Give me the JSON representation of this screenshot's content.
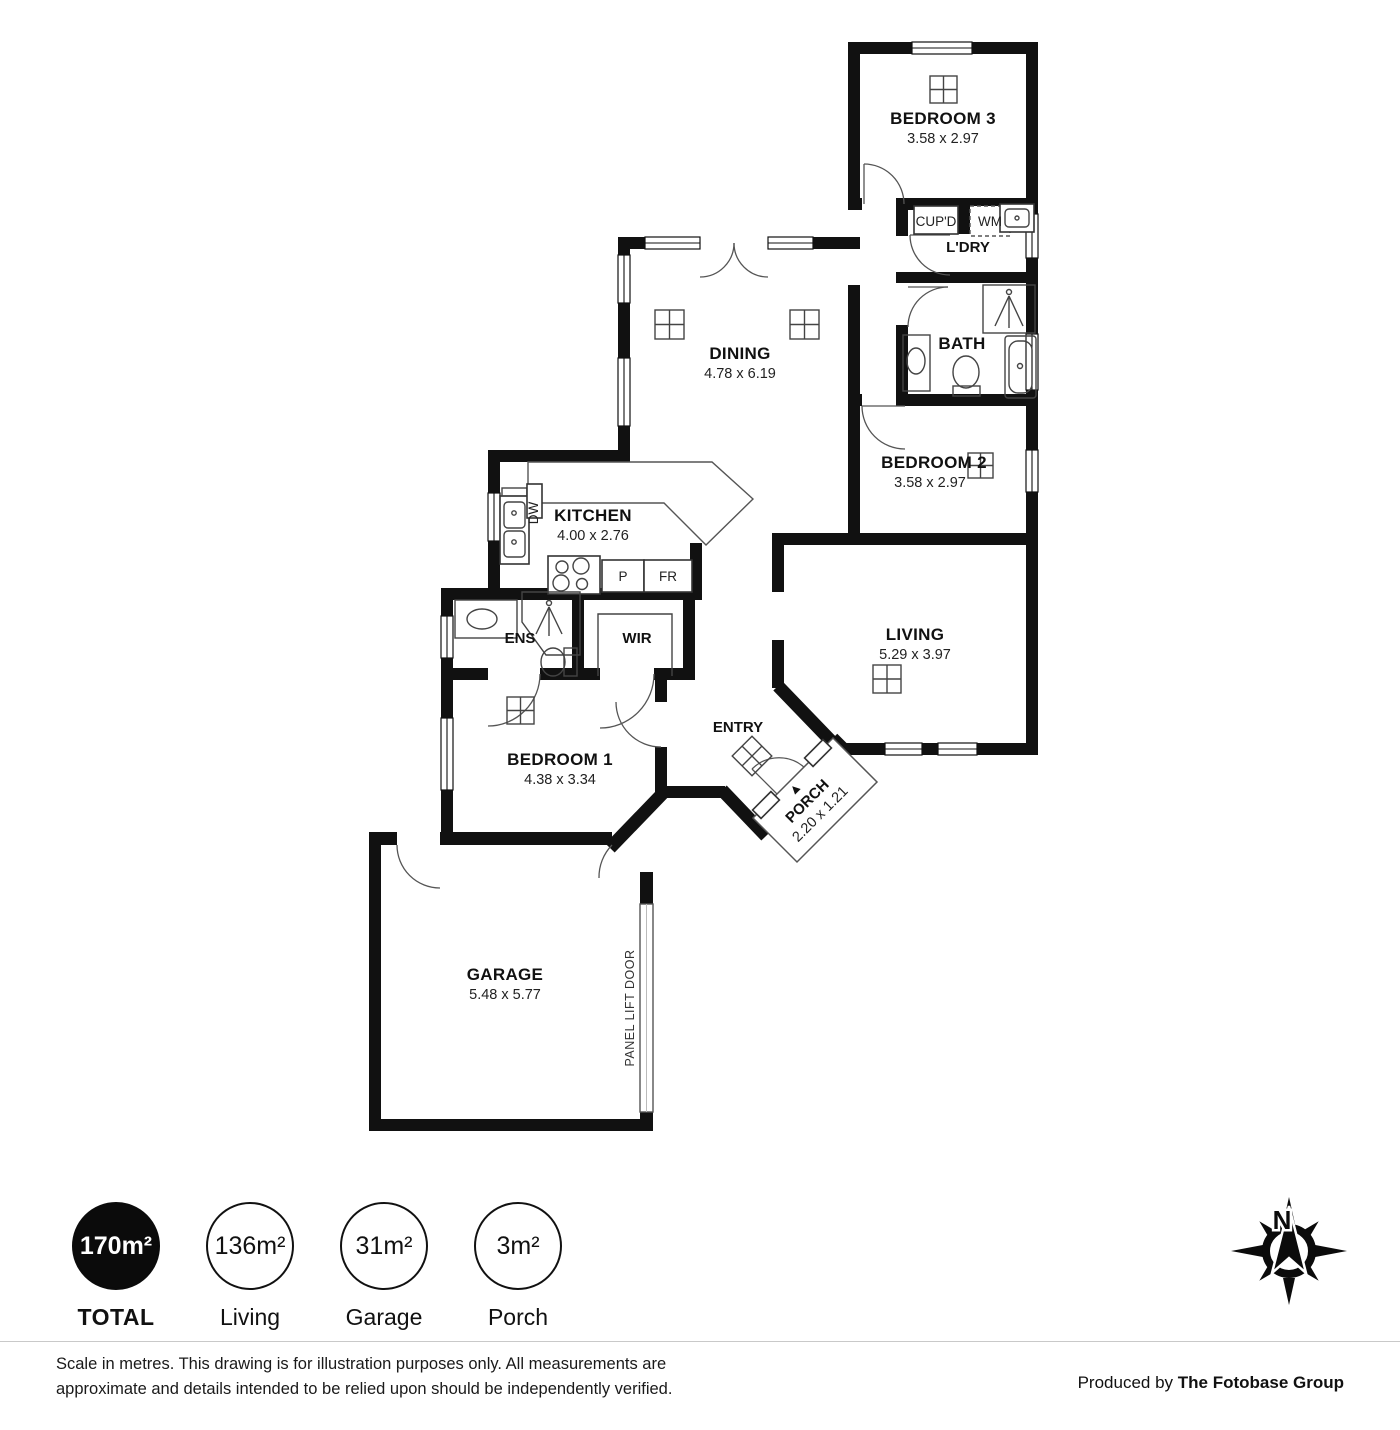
{
  "floorplan": {
    "rooms": {
      "bedroom3": {
        "name": "BEDROOM 3",
        "dims": "3.58 x 2.97"
      },
      "ldry": {
        "name": "L'DRY"
      },
      "cupd": {
        "name": "CUP'D"
      },
      "wm": {
        "name": "WM"
      },
      "bath": {
        "name": "BATH"
      },
      "bedroom2": {
        "name": "BEDROOM 2",
        "dims": "3.58 x 2.97"
      },
      "dining": {
        "name": "DINING",
        "dims": "4.78 x 6.19"
      },
      "kitchen": {
        "name": "KITCHEN",
        "dims": "4.00 x 2.76"
      },
      "dw": {
        "name": "DW"
      },
      "pantry": {
        "name": "P"
      },
      "fridge": {
        "name": "FR"
      },
      "ens": {
        "name": "ENS"
      },
      "wir": {
        "name": "WIR"
      },
      "bedroom1": {
        "name": "BEDROOM 1",
        "dims": "4.38 x 3.34"
      },
      "living": {
        "name": "LIVING",
        "dims": "5.29 x 3.97"
      },
      "entry": {
        "name": "ENTRY"
      },
      "porch": {
        "name": "PORCH",
        "dims": "2.20 x 1.21"
      },
      "garage": {
        "name": "GARAGE",
        "dims": "5.48 x 5.77"
      },
      "panel_lift_door": {
        "name": "PANEL LIFT DOOR"
      }
    },
    "compass": {
      "label": "N"
    }
  },
  "summary": {
    "items": [
      {
        "value": "170m²",
        "label": "TOTAL",
        "filled": true
      },
      {
        "value": "136m²",
        "label": "Living",
        "filled": false
      },
      {
        "value": "31m²",
        "label": "Garage",
        "filled": false
      },
      {
        "value": "3m²",
        "label": "Porch",
        "filled": false
      }
    ]
  },
  "footer": {
    "disclaimer_line1": "Scale in metres. This drawing is for illustration purposes only. All measurements are",
    "disclaimer_line2": "approximate and details intended to be relied upon should be independently verified.",
    "credit_prefix": "Produced by ",
    "credit_name": "The Fotobase Group"
  },
  "colors": {
    "wall": "#111111",
    "background": "#ffffff"
  }
}
